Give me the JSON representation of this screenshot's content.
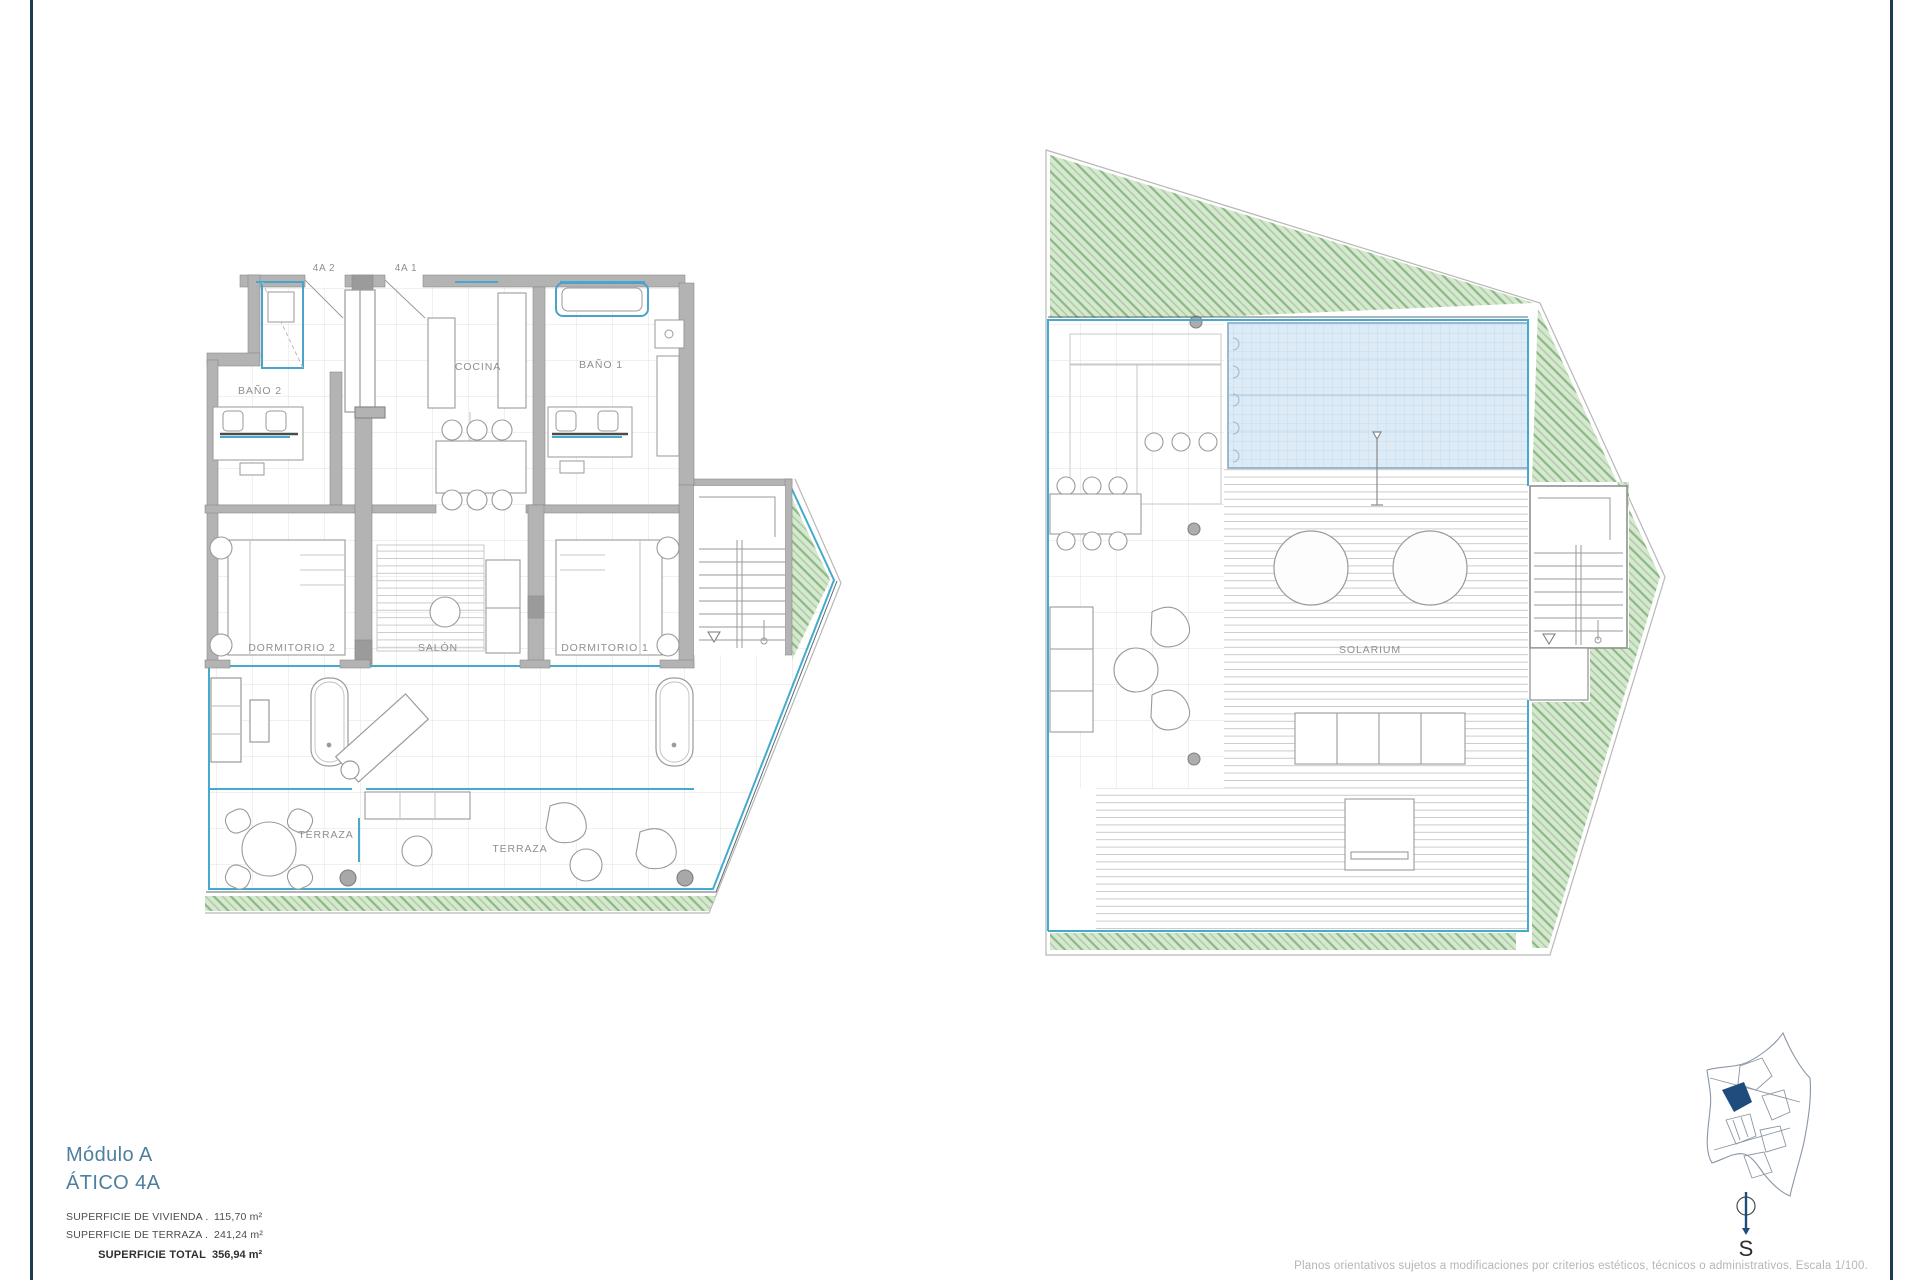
{
  "colors": {
    "rule": "#1d3c52",
    "accent_blue": "#4e7f9e",
    "glass": "#45aacd",
    "wall": "#b3b3b3",
    "grass": "#8cb884",
    "pool": "#dcebf6",
    "site_highlight": "#1f4c7d"
  },
  "left_plan": {
    "door_labels": {
      "left": "4A 2",
      "right": "4A 1"
    },
    "rooms": {
      "bano2": "BAÑO 2",
      "cocina": "COCINA",
      "bano1": "BAÑO 1",
      "dormitorio2": "DORMITORIO 2",
      "salon": "SALÓN",
      "dormitorio1": "DORMITORIO 1",
      "terraza_left": "TERRAZA",
      "terraza_right": "TERRAZA"
    }
  },
  "right_plan": {
    "rooms": {
      "solarium": "SOLARIUM"
    }
  },
  "title_block": {
    "module": "Módulo A",
    "unit": "ÁTICO 4A",
    "areas": [
      {
        "label": "SUPERFICIE DE VIVIENDA",
        "leader": " . . . . . . . . .",
        "value": "115,70 m²"
      },
      {
        "label": "SUPERFICIE DE TERRAZA",
        "leader": " . . . . . . . . . .",
        "value": "241,24 m²"
      }
    ],
    "total_label": "SUPERFICIE TOTAL",
    "total_value": "356,94 m²"
  },
  "compass": {
    "label": "S"
  },
  "footer": {
    "disclaimer": "Planos orientativos sujetos a modificaciones por criterios estéticos, técnicos o administrativos. Escala 1/100."
  }
}
